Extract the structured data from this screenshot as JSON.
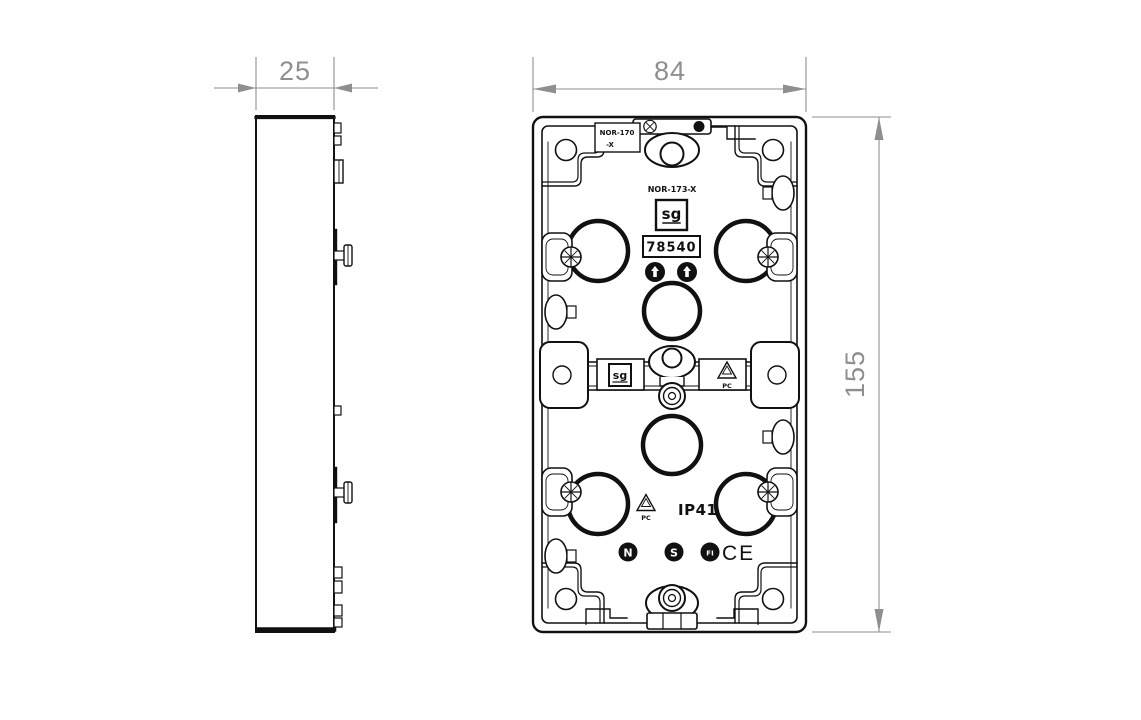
{
  "title": "Technical drawing - flush mounting back box, side and rear views",
  "dimensions": {
    "depth": "25",
    "width": "84",
    "height": "155"
  },
  "markings": {
    "mold_ref_line1": "NOR-170",
    "mold_ref_line2": "-X",
    "mold_ref_center": "NOR-173-X",
    "brand_logo_top": "sg",
    "part_number": "78540",
    "brand_logo_mid": "sg",
    "material_mid": "PC",
    "material_bottom": "PC",
    "ip_rating": "IP41",
    "cert_nemko": "N",
    "cert_semko": "S",
    "cert_fimko": "FI",
    "cert_ce": "CE"
  },
  "colors": {
    "line": "#111111",
    "dimension": "#8f8f8f",
    "background": "#ffffff"
  }
}
